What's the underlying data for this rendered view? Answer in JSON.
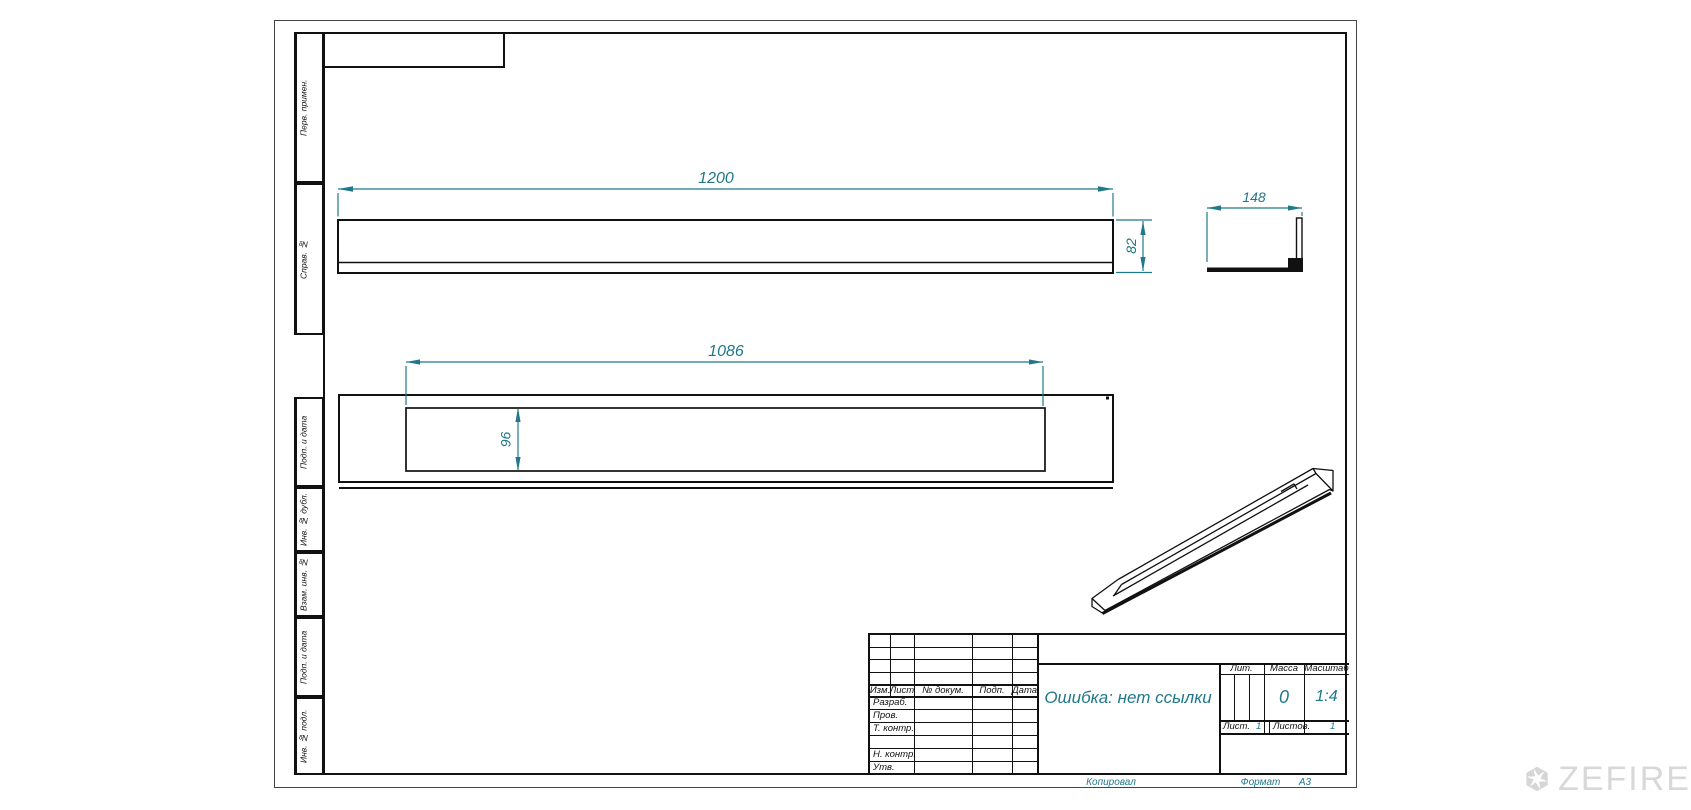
{
  "drawing": {
    "dims": {
      "length": "1200",
      "height": "82",
      "depth": "148",
      "slot_length": "1086",
      "slot_width": "96"
    }
  },
  "margin_stamps": {
    "items": [
      "Перв. примен.",
      "Справ. №",
      "Подп. и дата",
      "Инв. № дубл.",
      "Взам. инв. №",
      "Подп. и дата",
      "Инв. № подл."
    ]
  },
  "title_block": {
    "header_cols": [
      "Изм.",
      "Лист",
      "№ докум.",
      "Подп.",
      "Дата"
    ],
    "rows": [
      "Разраб.",
      "Пров.",
      "Т. контр.",
      "Н. контр.",
      "Утв."
    ],
    "doc_name": "Ошибка: нет ссылки",
    "lit_label": "Лит.",
    "mass_label": "Масса",
    "scale_label": "Масштаб",
    "mass_value": "0",
    "scale_value": "1:4",
    "sheet_label": "Лист.",
    "sheet_value": "1",
    "sheets_label": "Листов.",
    "sheets_value": "1"
  },
  "footer": {
    "copied": "Копировал",
    "format_label": "Формат",
    "format_value": "А3"
  },
  "watermark": {
    "brand": "ZEFIRE"
  },
  "colors": {
    "dimension": "#20788a",
    "line": "#111111",
    "watermark": "#d8d8d8"
  }
}
